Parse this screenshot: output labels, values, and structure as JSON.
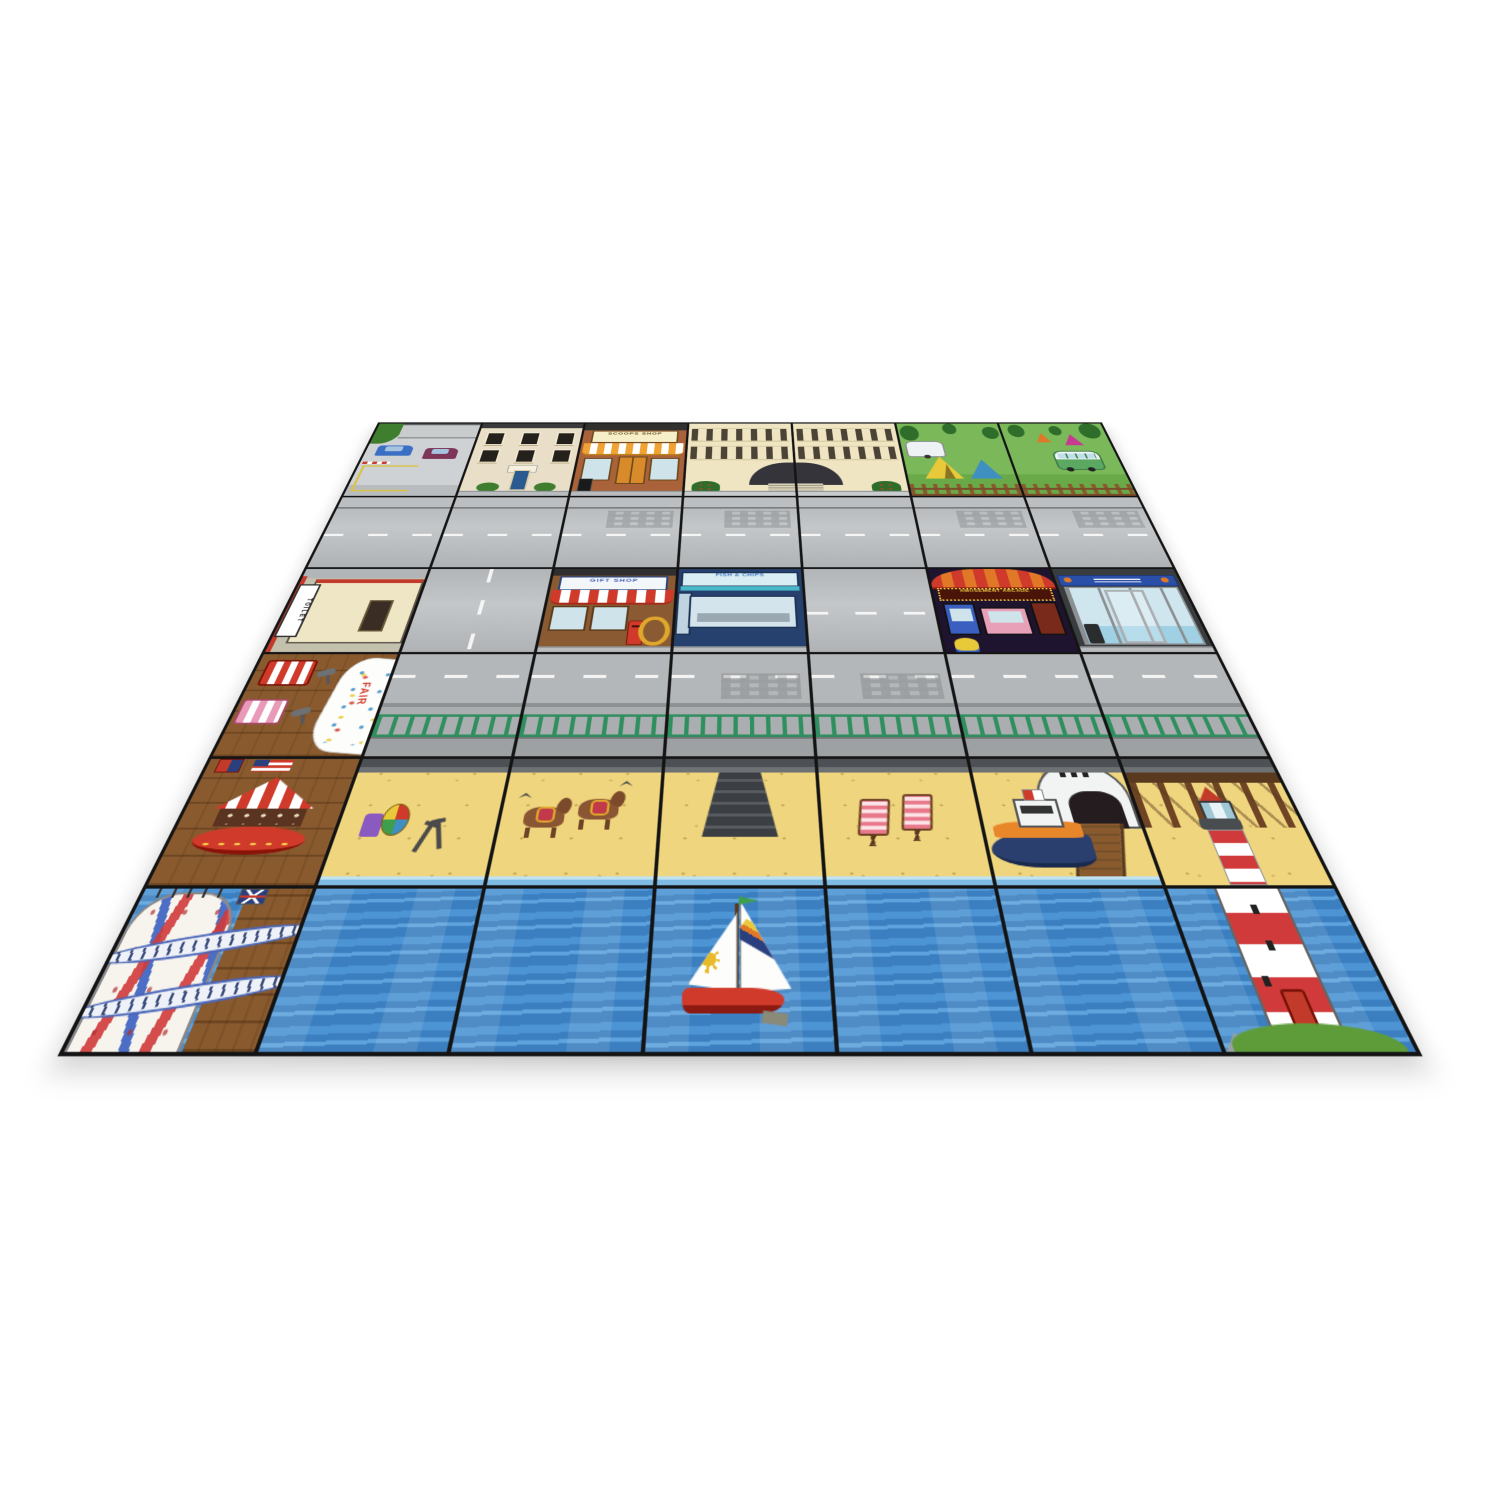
{
  "product": {
    "name": "Seaside town grid activity mat",
    "description": "Photograph of a modular seaside-town floor mat laid flat, viewed at an angle on a plain white background",
    "background_color": "#ffffff"
  },
  "mat": {
    "grid": {
      "columns": 7,
      "rows": 6,
      "line_color": "#141414"
    },
    "palette": {
      "road": "#b7babc",
      "pavement": "#bcbfc1",
      "sand": "#efd57d",
      "sea": "#3f86c6",
      "grass": "#74b455",
      "planks": "#8a5a2f",
      "railing_green": "#2f8f5f",
      "awning_red": "#d03a2a",
      "awning_orange": "#f0a232",
      "lighthouse_red": "#d03a3a"
    },
    "signs": {
      "toilet": "TOILET",
      "scoops_shop": "SCOOPS SHOP",
      "gift_shop": "GIFT SHOP",
      "fish_and_chips": "FISH & CHIPS",
      "arcade": "AMUSEMENT ARCADE",
      "fair_banner": "FAIR"
    },
    "rows": [
      {
        "name": "buildings",
        "tiles": [
          "car park with hedge, barrier and two parked cars",
          "apartment block with six windows and blue door",
          "scoops sweet shop with orange striped awning",
          "grand hotel left half with arched canopy",
          "grand hotel right half with arched canopy",
          "campsite with caravan, yellow tent and blue tent",
          "campsite with camper van, pink and orange tents"
        ]
      },
      {
        "name": "road",
        "tiles": [
          "road",
          "road",
          "road",
          "road",
          "road",
          "road",
          "road"
        ]
      },
      {
        "name": "seafront shops",
        "tiles": [
          "toilet block at pier entrance",
          "road junction with vertical markings",
          "gift shop with red striped awning, post box and life ring",
          "fish and chips shop with large window",
          "road",
          "amusement arcade with red canopy and machines",
          "travel shop with blue fascia and glass front"
        ]
      },
      {
        "name": "road and promenade",
        "tiles": [
          "pier boardwalk with fair banner, striped stalls and telescopes",
          "road with green promenade railing",
          "road with green promenade railing",
          "road with green promenade railing",
          "road with green promenade railing",
          "road with green promenade railing",
          "road with green promenade railing"
        ]
      },
      {
        "name": "beach",
        "tiles": [
          "pier with carousel and flags",
          "beach with ball, bag and spades",
          "beach with two donkeys and seagulls",
          "beach steps down from the promenade",
          "beach with two deck chairs",
          "lifeboat station with orange lifeboat on slipway",
          "wooden jetty with lighthouse top"
        ]
      },
      {
        "name": "sea",
        "tiles": [
          "pier end with red, white and blue helter skelter",
          "open sea",
          "open sea",
          "red sailboat with sun sail and rainbow sail",
          "open sea",
          "open sea",
          "red and white lighthouse on grassy rocks"
        ]
      }
    ]
  }
}
